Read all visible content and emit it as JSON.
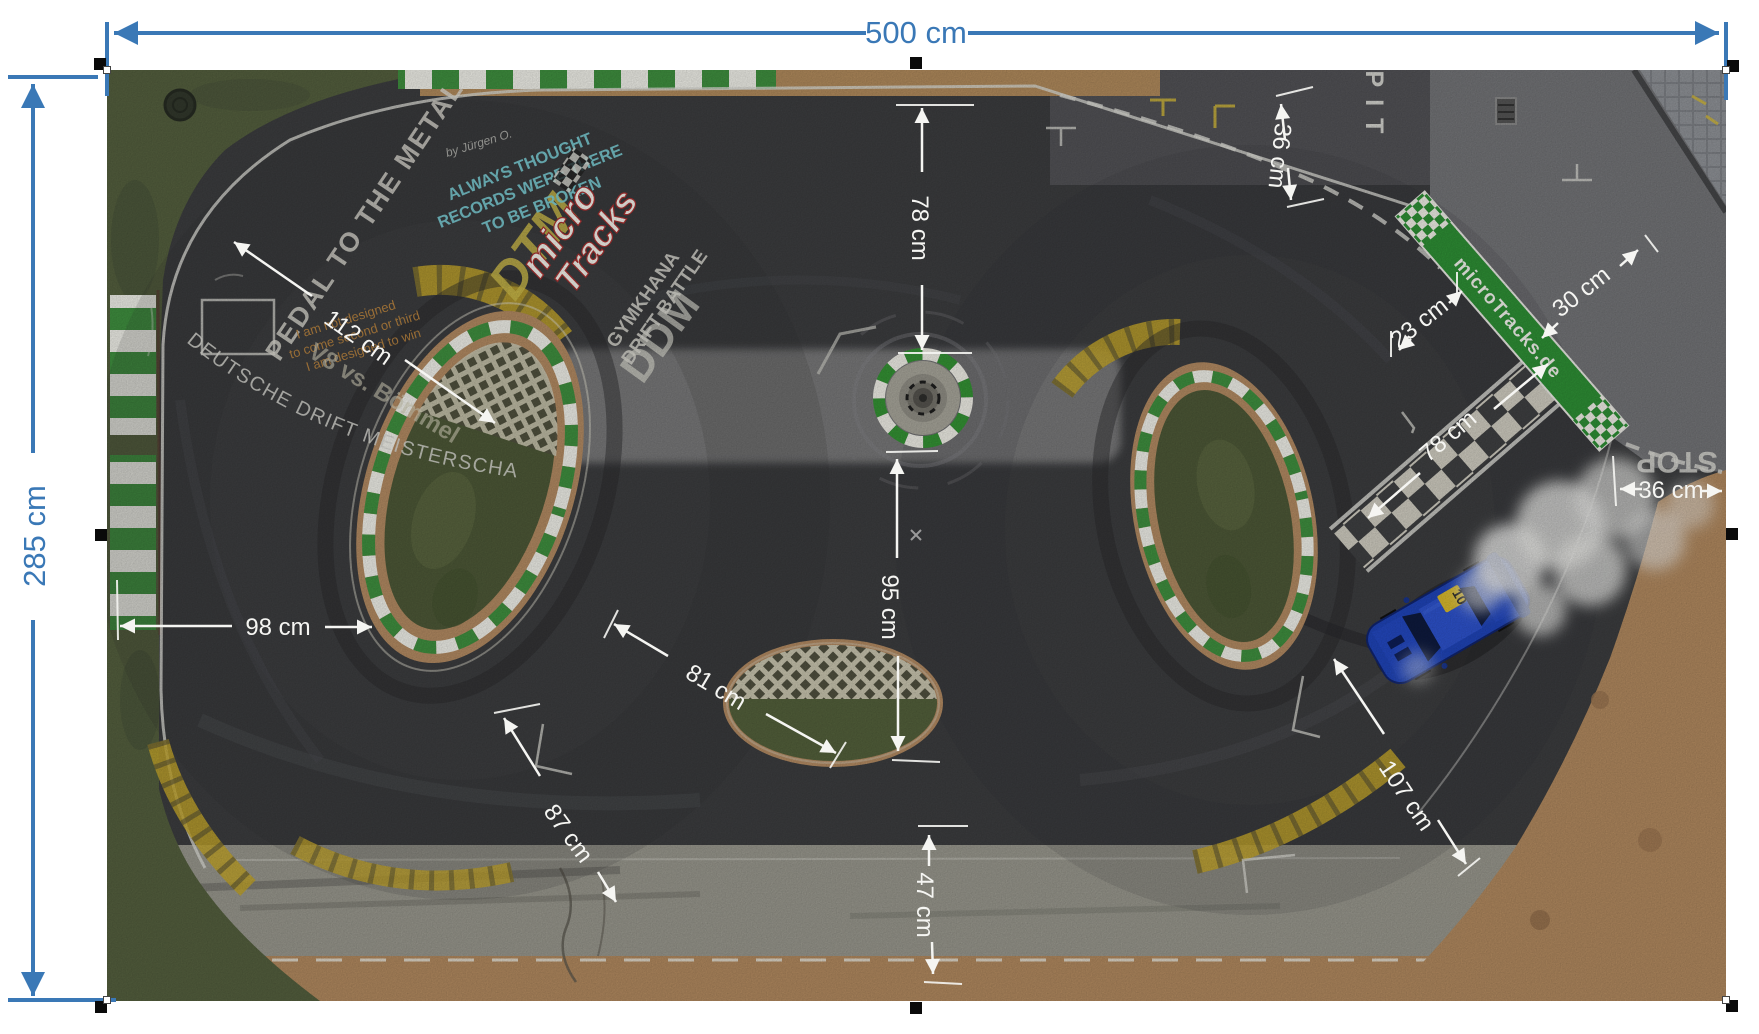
{
  "page": {
    "background": "#ffffff",
    "width": 1759,
    "height": 1034
  },
  "dimensions_blue": {
    "color": "#3a78b6",
    "width_label": "500 cm",
    "height_label": "285 cm"
  },
  "dimensions_white": {
    "color": "#f5f5f2",
    "top_78": "78 cm",
    "pit_36": "36 cm",
    "pit_23": "23 cm",
    "pit_30": "30 cm",
    "finish_78": "78 cm",
    "right_36": "36 cm",
    "left_112": "112 cm",
    "left_98": "98 cm",
    "mid_81": "81 cm",
    "mid_95": "95 cm",
    "bottom_87": "87 cm",
    "bottom_47": "47 cm",
    "right_107": "107 cm"
  },
  "track_markings": {
    "pit": "PIT",
    "stop": "STOP",
    "banner": "microTracks.de"
  },
  "graffiti": {
    "pedal": "PEDAL TO THE METAL",
    "dtm": "DTM",
    "ddm": "DDM",
    "always1": "ALWAYS THOUGHT",
    "always2": "RECORDS WERE THERE",
    "always3": "TO BE BROKEN",
    "credit": "by Jürgen O.",
    "logo_line1": "micro",
    "logo_line2": "Tracks",
    "gymkhana": "GYMKHANA",
    "drift_battle": "DRIFT BATTLE",
    "meisterschaft": "DEUTSCHE DRIFT MEISTERSCHAFT",
    "quote1": "I am not designed",
    "quote2": "to come second or third",
    "quote3": "I am designed to win",
    "versus": "V8 vs. Bömmel"
  },
  "car": {
    "number": "10",
    "color": "#1f44b8"
  },
  "colors": {
    "asphalt": "#3c3d3f",
    "concrete": "#737477",
    "dirt": "#b1895f",
    "grass": "#545f3e",
    "curb_green": "#3f8f3f",
    "banner_green": "#2e8f35",
    "yellow_curb": "#c2a42c",
    "chalk_cyan": "#7cd0d8",
    "chalk_yellow": "#c9b84a",
    "chalk_orange": "#c08840"
  }
}
